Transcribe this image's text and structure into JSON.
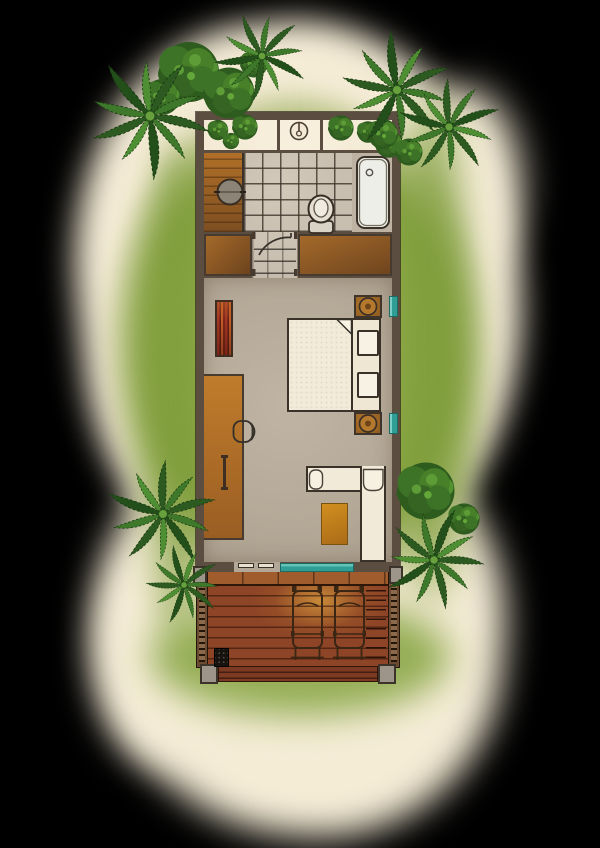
{
  "scene": {
    "kind": "watercolor-style resort bungalow floor plan, top-down view, no text labels",
    "depicted_elements": [
      "outdoor-shower-garden",
      "shower-icon",
      "wash-basin",
      "bathtub",
      "toilet",
      "closet",
      "wardrobe",
      "door-swing",
      "bed",
      "pillows",
      "bedside-tables",
      "teal-windows",
      "luggage-rack",
      "desk",
      "desk-chair",
      "l-shaped-daybed",
      "rug",
      "sliding-glass-door",
      "timber-deck",
      "sun-loungers",
      "deck-railings",
      "stone-posts",
      "door-mat",
      "palm-trees",
      "round-trees",
      "garden-shrubs",
      "lawn"
    ]
  },
  "colors": {
    "background": "#000000",
    "wash_cream": "#f5ecd6",
    "grass_green": "#93ad4c",
    "grass_dark": "#7d9c3a",
    "wall": "#5b4e41",
    "tile": "#c9bfb1",
    "garden_cream": "#f3e9d4",
    "wood_vanity": "#a86827",
    "wood_desk": "#b37428",
    "wood_wardrobe": "#8f5a24",
    "floor_bedroom": "#b5a998",
    "bed_linen": "#f2ebd9",
    "tub_white": "#edeee7",
    "teal_glass": "#2f9f95",
    "rug_amber": "#c98a1d",
    "rack_red": "#9e3322",
    "deck_wood": "#8e4527",
    "deck_glow": "#c28d3e",
    "stone_post": "#9d958a",
    "mat_black": "#16130f",
    "palm_green": "#39762b",
    "bush_green": "#2f5c1f"
  },
  "trees": {
    "palms": [
      {
        "x": 150,
        "y": 116,
        "s": 1.15,
        "r": 18
      },
      {
        "x": 262,
        "y": 56,
        "s": 0.85,
        "r": -40
      },
      {
        "x": 397,
        "y": 90,
        "s": 1.05,
        "r": 52
      },
      {
        "x": 449,
        "y": 127,
        "s": 0.92,
        "r": 128
      },
      {
        "x": 163,
        "y": 514,
        "s": 1.02,
        "r": -12
      },
      {
        "x": 184,
        "y": 585,
        "s": 0.72,
        "r": 42
      },
      {
        "x": 434,
        "y": 560,
        "s": 0.95,
        "r": 80
      }
    ],
    "bushes": [
      {
        "x": 189,
        "y": 72,
        "s": 1.0
      },
      {
        "x": 229,
        "y": 93,
        "s": 0.85
      },
      {
        "x": 162,
        "y": 97,
        "s": 0.6
      },
      {
        "x": 254,
        "y": 64,
        "s": 0.45
      },
      {
        "x": 426,
        "y": 491,
        "s": 0.95
      },
      {
        "x": 464,
        "y": 519,
        "s": 0.52
      },
      {
        "x": 383,
        "y": 134,
        "s": 0.5
      },
      {
        "x": 409,
        "y": 152,
        "s": 0.45
      }
    ],
    "garden_bushes": [
      {
        "x": 218,
        "y": 130,
        "s": 0.34
      },
      {
        "x": 245,
        "y": 127,
        "s": 0.42
      },
      {
        "x": 231,
        "y": 141,
        "s": 0.27
      },
      {
        "x": 341,
        "y": 128,
        "s": 0.42
      },
      {
        "x": 368,
        "y": 132,
        "s": 0.36
      },
      {
        "x": 389,
        "y": 144,
        "s": 0.46
      }
    ]
  }
}
